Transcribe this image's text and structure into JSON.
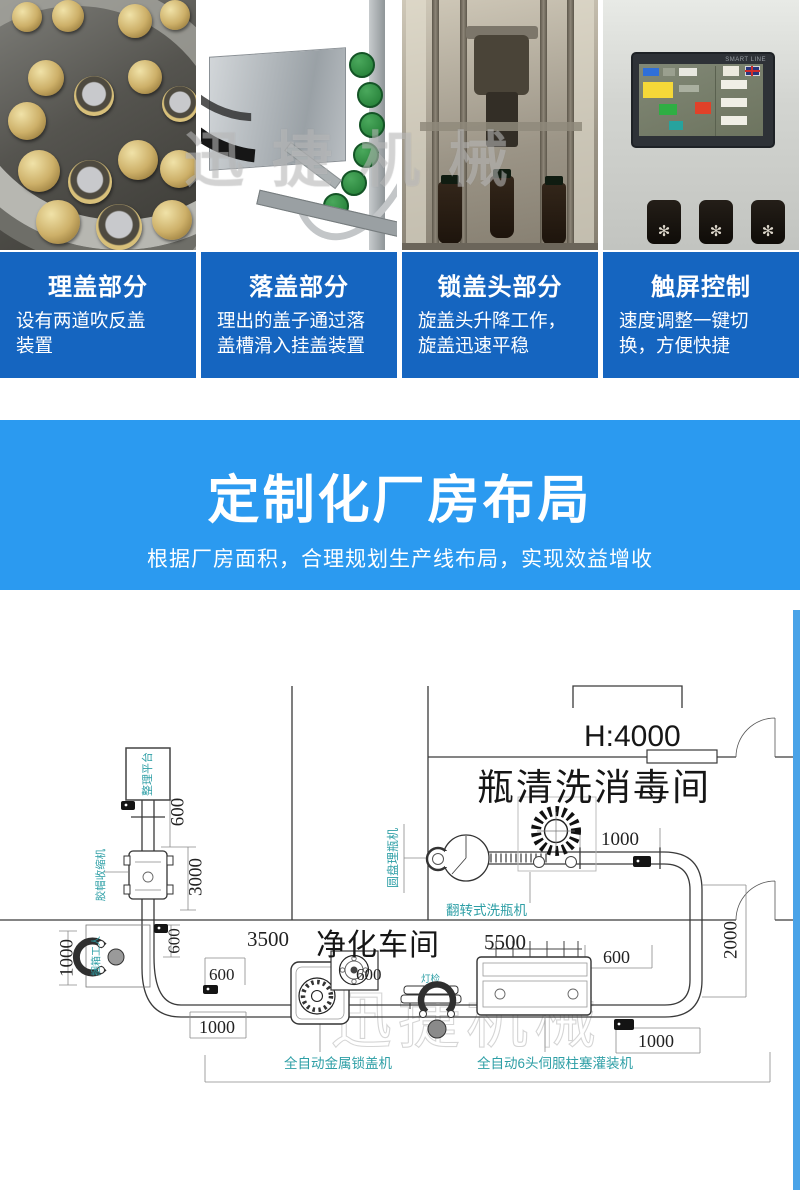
{
  "colors": {
    "card_blue": "#1565c0",
    "banner_blue": "#2b9af0",
    "frame_blue": "#4aa3e8",
    "label_teal": "#2e9fa6"
  },
  "photo_strip": {
    "watermark": "迅捷机械",
    "hmi_brand": "SMART LINE"
  },
  "cards": [
    {
      "title": "理盖部分",
      "desc": "设有两道吹反盖\n装置"
    },
    {
      "title": "落盖部分",
      "desc": "理出的盖子通过落\n盖槽滑入挂盖装置"
    },
    {
      "title": "锁盖头部分",
      "desc": "旋盖头升降工作，\n旋盖迅速平稳"
    },
    {
      "title": "触屏控制",
      "desc": "速度调整一键切\n换，方便快捷"
    }
  ],
  "banner": {
    "title": "定制化厂房布局",
    "subtitle": "根据厂房面积，合理规划生产线布局，实现效益增收"
  },
  "floor_plan": {
    "watermark": "迅捷机械",
    "height_label": "H:4000",
    "rooms": {
      "wash": "瓶清洗消毒间",
      "clean": "净化车间"
    },
    "machines": {
      "platform": "整理平台",
      "shrink": "胶帽收缩机",
      "packer": "捆箱工人",
      "disc": "圆盘理瓶机",
      "washer": "翻转式洗瓶机",
      "capper": "全自动金属锁盖机",
      "lamp": "灯检",
      "filler": "全自动6头伺服柱塞灌装机"
    },
    "dims": {
      "top600": "600",
      "v3000": "3000",
      "left1000": "1000",
      "wall600": "600",
      "span3500": "3500",
      "span5500": "5500",
      "mid600": "600",
      "elbow600": "600",
      "right600": "600",
      "wash1000": "1000",
      "right2000": "2000",
      "botleft1000": "1000",
      "botright1000": "1000"
    }
  }
}
